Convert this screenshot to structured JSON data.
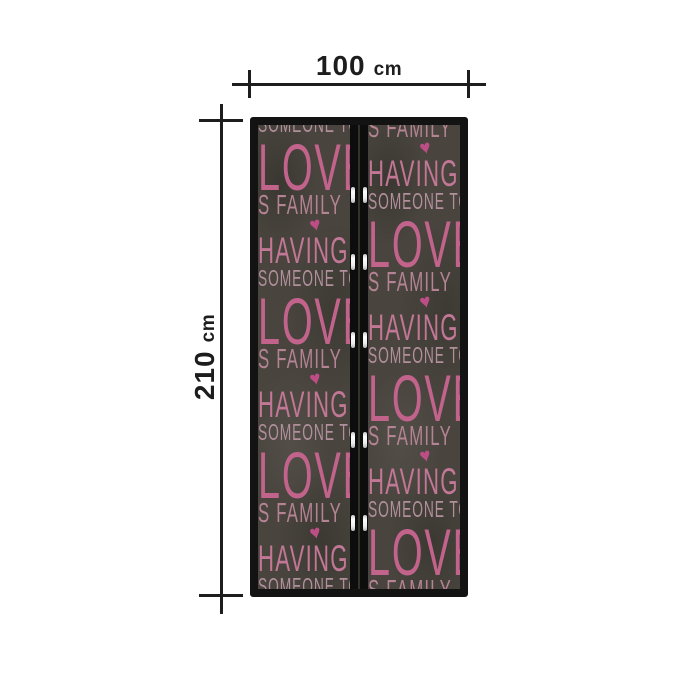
{
  "dimensions": {
    "width": {
      "value": "100",
      "unit": "cm"
    },
    "height": {
      "value": "210",
      "unit": "cm"
    }
  },
  "door": {
    "pattern_words": {
      "love": "LOVE",
      "family": "S FAMILY",
      "having": "HAVING",
      "someone": "SOMEONE TO",
      "heart": "♥"
    },
    "left_panel_lines": [
      {
        "w": "someone",
        "cut": "top"
      },
      {
        "w": "love"
      },
      {
        "w": "family"
      },
      {
        "w": "heart"
      },
      {
        "w": "having"
      },
      {
        "w": "someone"
      },
      {
        "w": "love"
      },
      {
        "w": "family"
      },
      {
        "w": "heart"
      },
      {
        "w": "having"
      },
      {
        "w": "someone"
      },
      {
        "w": "love"
      },
      {
        "w": "family"
      },
      {
        "w": "heart"
      },
      {
        "w": "having"
      },
      {
        "w": "someone"
      }
    ],
    "right_panel_lines": [
      {
        "w": "family",
        "cut": "top"
      },
      {
        "w": "heart"
      },
      {
        "w": "having"
      },
      {
        "w": "someone"
      },
      {
        "w": "love"
      },
      {
        "w": "family"
      },
      {
        "w": "heart"
      },
      {
        "w": "having"
      },
      {
        "w": "someone"
      },
      {
        "w": "love"
      },
      {
        "w": "family"
      },
      {
        "w": "heart"
      },
      {
        "w": "having"
      },
      {
        "w": "someone"
      },
      {
        "w": "love"
      },
      {
        "w": "family"
      }
    ],
    "magnet_positions_pct": [
      15.1,
      29.5,
      46.3,
      67.9,
      85.8
    ]
  },
  "colors": {
    "dimline": "#1d1d1d",
    "frame": "#131313",
    "panel": "#49453e",
    "strip": "#0d0d0d",
    "love": "#c2638c",
    "having": "#c17795",
    "family": "#b48394",
    "someone": "#b18f9c",
    "heart": "#bd4e85",
    "magnet": "#ededed"
  }
}
